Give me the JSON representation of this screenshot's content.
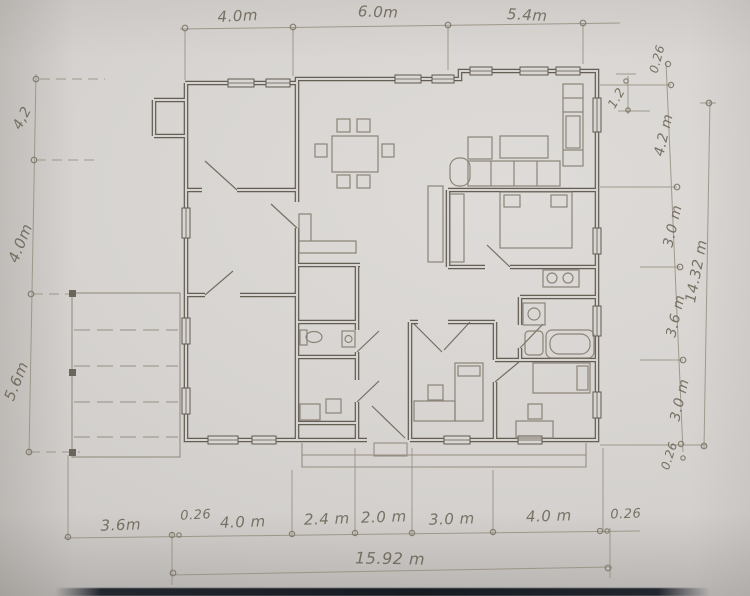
{
  "document": {
    "type": "hand-drawn architectural floor plan (pencil on paper photo)"
  },
  "dims": {
    "top": [
      "4.0m",
      "6.0m",
      "5.4m"
    ],
    "left": [
      "4,2",
      "4.0m",
      "5.6m"
    ],
    "right": [
      "0.26",
      "1.2",
      "4.2 m",
      "3.0 m",
      "3.6 m",
      "3.0 m",
      "0.26"
    ],
    "right_total": "14.32 m",
    "bottom": [
      "3.6m",
      "0.26",
      "4.0 m",
      "2.4 m",
      "2.0 m",
      "3.0 m",
      "4.0 m",
      "0.26"
    ],
    "bottom_total": "15.92 m"
  },
  "colors": {
    "paper": "#d6d3d0",
    "pencil_wall": "#5a544a",
    "pencil_light": "#968f80",
    "handwriting": "#6b6455",
    "desk_edge": "#171b22"
  }
}
